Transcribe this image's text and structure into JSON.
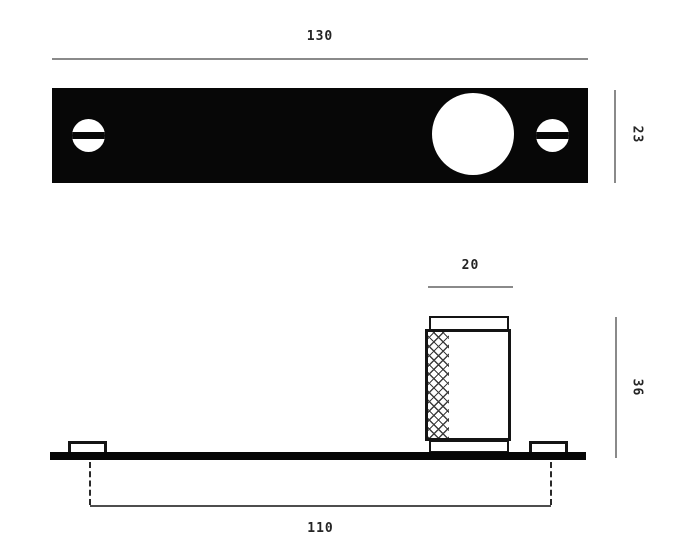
{
  "drawing": {
    "type": "technical-dimension-drawing",
    "views": {
      "top_view": {
        "plate_width": "130",
        "plate_height": "23"
      },
      "side_view": {
        "knob_diameter": "20",
        "knob_height": "36",
        "screw_spacing": "110"
      }
    },
    "colors": {
      "plate_fill": "#070707",
      "outline": "#141414",
      "dimension_line": "#8a8a8a",
      "spacing_line": "#4d4d4d",
      "label_text": "#242424",
      "background": "#ffffff"
    }
  }
}
